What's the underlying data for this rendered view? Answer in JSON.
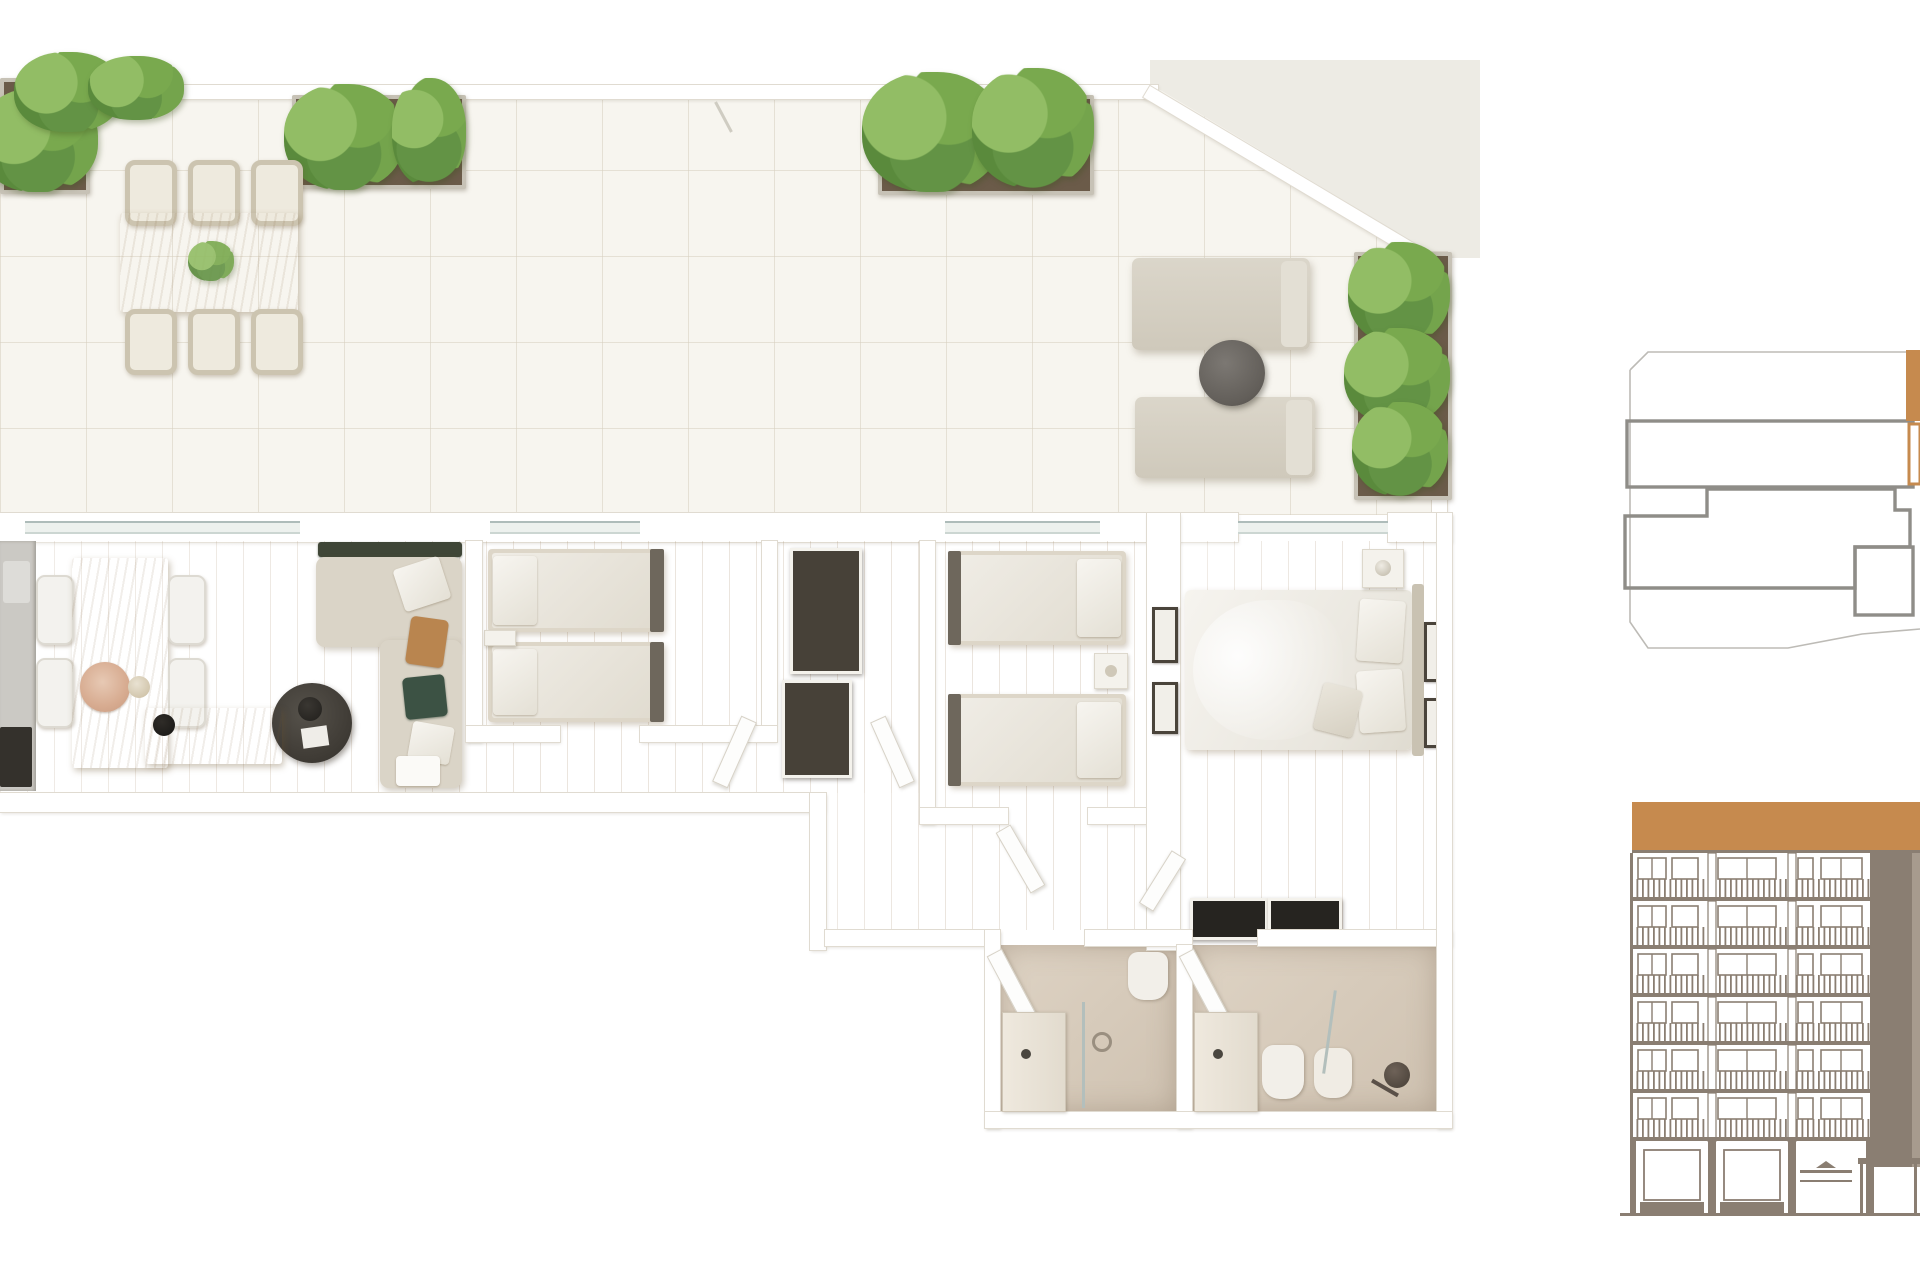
{
  "floorplan": {
    "name": "3D apartment floor plan render (top view)",
    "rooms": [
      {
        "id": "terrace",
        "name": "Terrace",
        "furniture": [
          "outdoor dining table",
          "six woven dining chairs",
          "two sun loungers",
          "round side table",
          "five green planters"
        ]
      },
      {
        "id": "living-dining",
        "name": "Living / Dining Room",
        "furniture": [
          "kitchen counter",
          "wood dining table",
          "four white chairs",
          "corner sofa with cushions",
          "round black coffee table",
          "wood sideboard with lamp"
        ]
      },
      {
        "id": "bedroom-1",
        "name": "Bedroom 1",
        "furniture": [
          "twin bed",
          "twin bed",
          "nightstand"
        ]
      },
      {
        "id": "hallway",
        "name": "Hallway",
        "furniture": [
          "dark wardrobe",
          "dark wardrobe",
          "double swing doors"
        ]
      },
      {
        "id": "bedroom-2",
        "name": "Bedroom 2",
        "furniture": [
          "twin bed",
          "twin bed",
          "nightstand",
          "two wall frames"
        ]
      },
      {
        "id": "master-bedroom",
        "name": "Master Bedroom",
        "furniture": [
          "double bed with white duvet",
          "nightstand",
          "black wardrobe",
          "two wall frames"
        ]
      },
      {
        "id": "bathroom-1",
        "name": "Bathroom 1",
        "furniture": [
          "vanity with sink",
          "toilet",
          "walk-in shower"
        ]
      },
      {
        "id": "bathroom-2",
        "name": "Bathroom 2",
        "furniture": [
          "vanity with sink",
          "toilet",
          "bidet",
          "walk-in shower with glass screen"
        ]
      }
    ]
  },
  "keyplan": {
    "name": "Floor location key plan",
    "highlighted_unit": "top-right unit (cut off at image edge)",
    "line_color": "#8f8d88",
    "outline_color": "#bdbbb6",
    "highlight_color": "#c68a4e"
  },
  "elevation": {
    "name": "Building street elevation",
    "floors": 6,
    "highlighted_level": "attic / top floor band",
    "line_color": "#8a7e72",
    "solid_mass_color": "#8a7e72",
    "highlight_color": "#c68a4e"
  },
  "palette": {
    "background": "#ffffff",
    "terrace_tile": "#f7f5ef",
    "tile_line": "#d6cfbf",
    "wood_floor": "#d9c3a2",
    "wall": "#ffffff",
    "wall_edge": "#e0dbd1",
    "glass": "#aebcba",
    "furniture_beige": "#d7d2c6",
    "dark_furniture": "#474138",
    "plant_green": "#6f9f48",
    "soil_brown": "#6b5b49",
    "linen_white": "#f0eee8",
    "bath_floor": "#d8cec0",
    "accent_orange": "#c68a4e",
    "drawing_taupe": "#8a7e72"
  }
}
